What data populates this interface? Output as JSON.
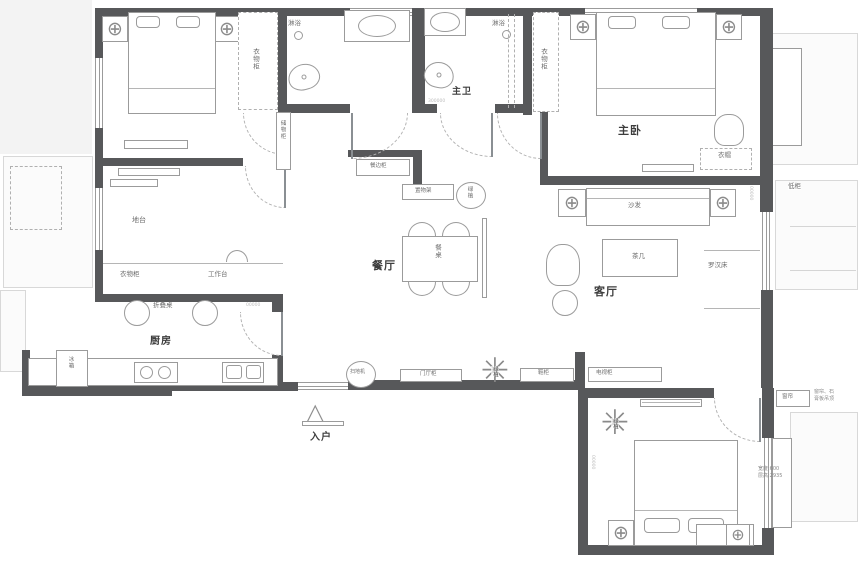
{
  "plan": {
    "rooms": {
      "master_bedroom": "主卧",
      "master_bath": "主卫",
      "dining": "餐厅",
      "living": "客厅",
      "kitchen": "厨房",
      "entry": "入户"
    },
    "labels": {
      "shower_a": "淋浴",
      "shower_b": "淋浴",
      "wardrobe_a": "衣物柜",
      "wardrobe_b": "衣物柜",
      "wardrobe_c": "衣物柜",
      "storage_cabinet": "储物柜",
      "platform": "地台",
      "worktop": "工作台",
      "folding_table": "折叠桌",
      "fridge": "冰箱",
      "sideboard": "餐边柜",
      "shelf": "置物架",
      "plant_dining": "绿植",
      "dining_table": "餐桌",
      "sofa": "沙发",
      "tea_table": "茶几",
      "daybed": "罗汉床",
      "low_cabinet": "低柜",
      "coat": "衣帽",
      "robot_vacuum": "扫地机",
      "hall_cabinet": "门厅柜",
      "plant_entry": "绿植",
      "shoe_cabinet": "鞋柜",
      "tv_cabinet": "电视柜",
      "plant_bedroom": "绿植",
      "curtain": "窗帘"
    },
    "notes": {
      "ceiling_1": "窗帘、石",
      "ceiling_2": "膏板吊顶",
      "bay_1": "宽度:600",
      "bay_2": "层高:2935"
    },
    "dims": {
      "d1": "300000",
      "d2": "00000",
      "d3": "00000",
      "d4": "00000"
    },
    "icons": {
      "round_table": "⊕",
      "plant": "✳",
      "entry_arrow": "△"
    },
    "colors": {
      "wall": "#57585a",
      "furniture_line": "#9b9b9b",
      "faint_line": "#d8d8d8",
      "room_text": "#3d3d3d",
      "small_text": "#6e6e6e"
    }
  }
}
